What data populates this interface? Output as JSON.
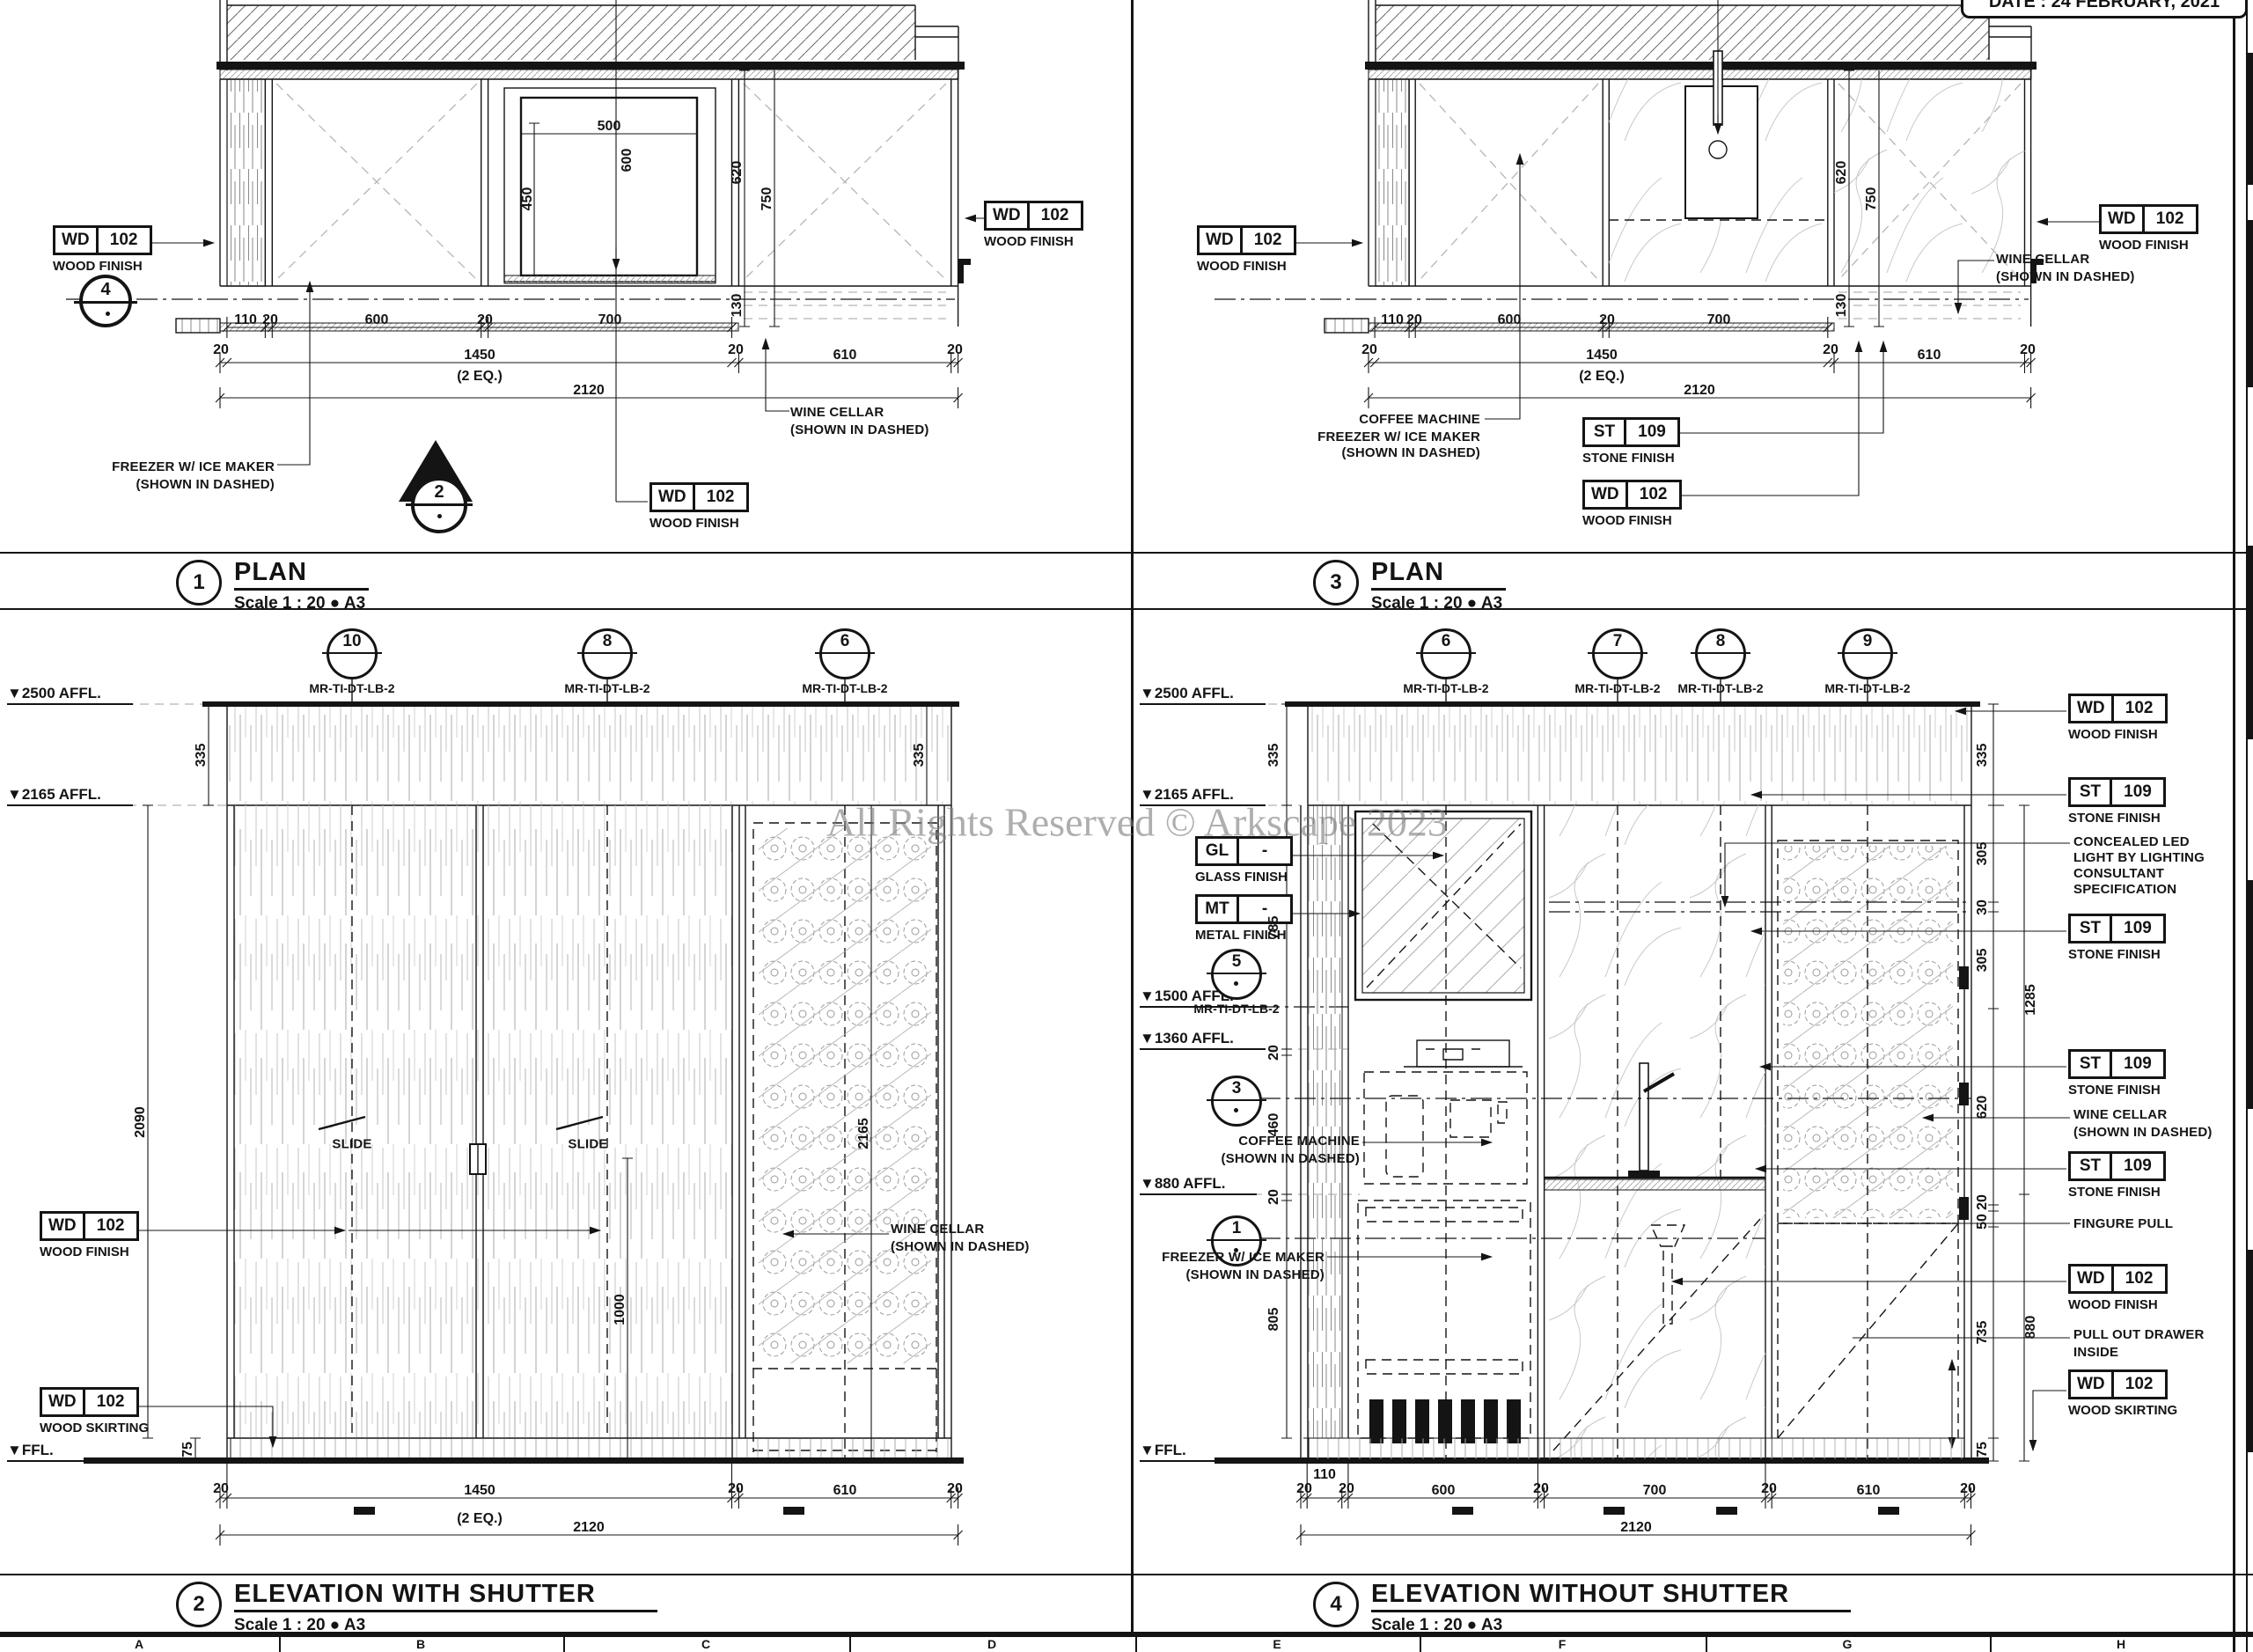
{
  "sheet": {
    "date_stamp": "DATE : 24 FEBRUARY, 2021",
    "watermark": "All Rights Reserved © Arkscape 2023",
    "grid_letters": [
      "A",
      "B",
      "C",
      "D",
      "E",
      "F",
      "G",
      "H"
    ]
  },
  "views": {
    "plan1": {
      "num": "1",
      "title": "PLAN",
      "scale": "Scale 1 : 20 ● A3"
    },
    "plan3": {
      "num": "3",
      "title": "PLAN",
      "scale": "Scale 1 : 20 ● A3"
    },
    "elev2": {
      "num": "2",
      "title": "ELEVATION WITH SHUTTER",
      "scale": "Scale 1 : 20 ● A3"
    },
    "elev4": {
      "num": "4",
      "title": "ELEVATION WITHOUT SHUTTER",
      "scale": "Scale 1 : 20 ● A3"
    }
  },
  "marker_ref": "MR-TI-DT-LB-2",
  "markers": {
    "plan1_section": "4",
    "plan1_tri": "2",
    "elev2": [
      "10",
      "8",
      "6"
    ],
    "elev4": [
      "6",
      "7",
      "8",
      "9"
    ],
    "side4": [
      "5",
      "3",
      "1"
    ]
  },
  "tags": {
    "wd": {
      "code": "WD",
      "num": "102"
    },
    "st": {
      "code": "ST",
      "num": "109"
    },
    "gl": {
      "code": "GL",
      "num": "-"
    },
    "mt": {
      "code": "MT",
      "num": "-"
    }
  },
  "labels": {
    "wood_finish": "WOOD FINISH",
    "wood_skirting": "WOOD SKIRTING",
    "stone_finish": "STONE FINISH",
    "glass_finish": "GLASS FINISH",
    "metal_finish": "METAL FINISH",
    "freezer": [
      "FREEZER W/ ICE MAKER",
      "(SHOWN IN DASHED)"
    ],
    "coffee_freezer": [
      "COFFEE MACHINE",
      "FREEZER W/ ICE MAKER",
      "(SHOWN IN DASHED)"
    ],
    "coffee": [
      "COFFEE MACHINE",
      "(SHOWN IN DASHED)"
    ],
    "wine": [
      "WINE CELLAR",
      "(SHOWN IN DASHED)"
    ],
    "led": [
      "CONCEALED LED",
      "LIGHT BY LIGHTING",
      "CONSULTANT",
      "SPECIFICATION"
    ],
    "finger_pull": "FINGURE PULL",
    "drawer": [
      "PULL OUT DRAWER",
      "INSIDE"
    ],
    "slide": "SLIDE"
  },
  "levels": {
    "l2500": "▼2500 AFFL.",
    "l2165": "▼2165 AFFL.",
    "l1500": "▼1500 AFFL.",
    "l1360": "▼1360 AFFL.",
    "l880": "▼880 AFFL.",
    "ffl": "▼FFL."
  },
  "dims": {
    "20": "20",
    "30": "30",
    "50": "50",
    "75": "75",
    "110": "110",
    "130": "130",
    "305": "305",
    "335": "335",
    "450": "450",
    "460": "460",
    "500": "500",
    "600": "600",
    "610": "610",
    "620": "620",
    "700": "700",
    "735": "735",
    "750": "750",
    "785": "785",
    "805": "805",
    "880": "880",
    "1000": "1000",
    "1285": "1285",
    "1450": "1450",
    "2090": "2090",
    "2120": "2120",
    "2165": "2165",
    "eq": "(2 EQ.)"
  }
}
